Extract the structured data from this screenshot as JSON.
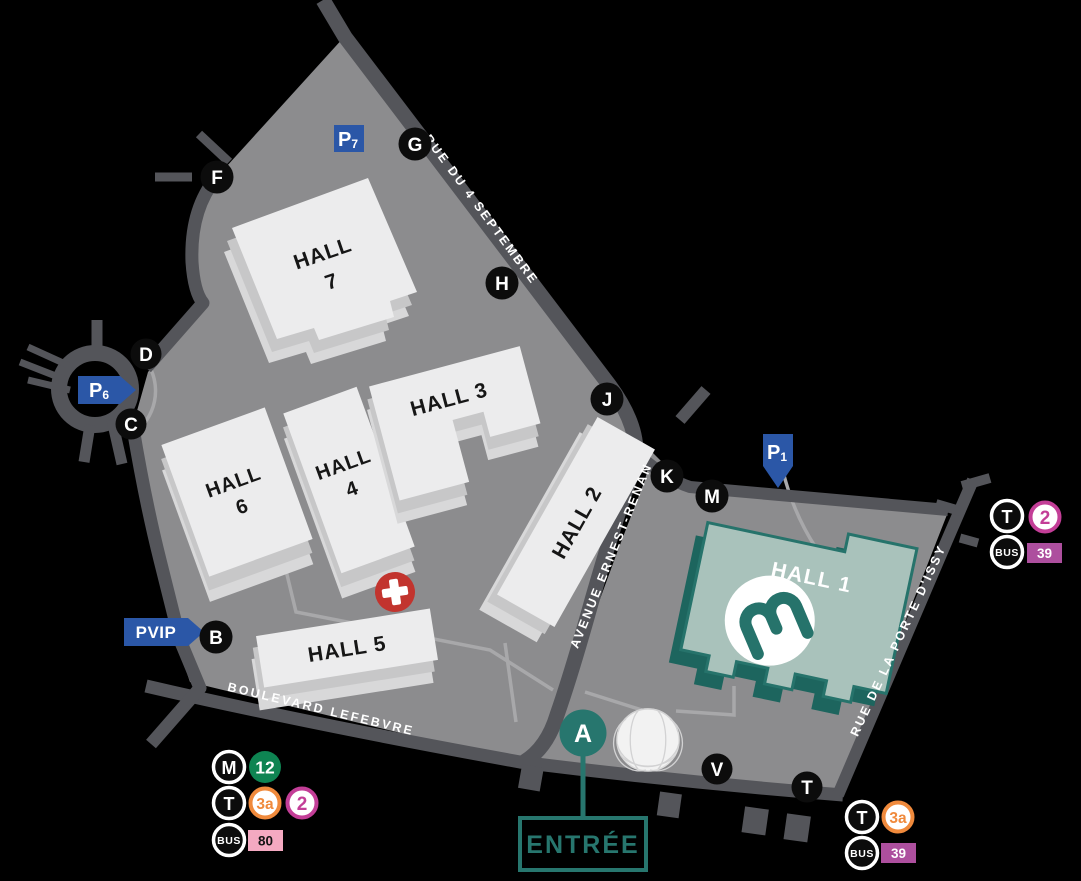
{
  "map": {
    "colors": {
      "background": "#000000",
      "ground": "#8c8c8e",
      "road": "#54555a",
      "walkway": "#a8a8aa",
      "building_top": "#ececed",
      "building_side": "#c7c7c8",
      "teal": "#27766e",
      "hall1_fill": "#a9c2bb",
      "blue": "#2b57a7",
      "marker_black": "#0c0c0c",
      "first_aid_red": "#c2342e",
      "metro12_green": "#0e8452",
      "tram3a_orange": "#f08a3c",
      "tram2_magenta": "#c33e97",
      "bus80_pink": "#f4a9c1",
      "bus39_mauve": "#ad4f9e"
    },
    "halls": {
      "h7": {
        "line1": "HALL",
        "line2": "7"
      },
      "h6": {
        "line1": "HALL",
        "line2": "6"
      },
      "h4": {
        "line1": "HALL",
        "line2": "4"
      },
      "h3": {
        "label": "HALL 3"
      },
      "h2": {
        "label": "HALL 2"
      },
      "h5": {
        "label": "HALL 5"
      },
      "h1": {
        "label": "HALL 1"
      }
    },
    "streets": {
      "north": "RUE DU 4 SEPTEMBRE",
      "middle": "AVENUE ERNEST-RENAN",
      "south": "BOULEVARD LEFEBVRE",
      "east": "RUE DE LA PORTE D'ISSY"
    },
    "gates": {
      "f": "F",
      "g": "G",
      "h": "H",
      "d": "D",
      "c": "C",
      "j": "J",
      "k": "K",
      "m": "M",
      "b": "B",
      "v": "V",
      "t": "T"
    },
    "entrance": {
      "gate": "A",
      "label": "ENTRÉE"
    },
    "parkings": {
      "p7": {
        "p": "P",
        "n": "7"
      },
      "p6": {
        "p": "P",
        "n": "6"
      },
      "p1": {
        "p": "P",
        "n": "1"
      },
      "pvip": {
        "label": "PVIP"
      }
    },
    "first_aid": {
      "symbol": "+"
    },
    "logo": {
      "letter": "m"
    },
    "transit": {
      "modes": {
        "metro": "M",
        "tram": "T",
        "bus": "BUS"
      },
      "lines": {
        "m12": "12",
        "t3a": "3a",
        "t2": "2",
        "b39": "39",
        "b80": "80"
      }
    }
  }
}
